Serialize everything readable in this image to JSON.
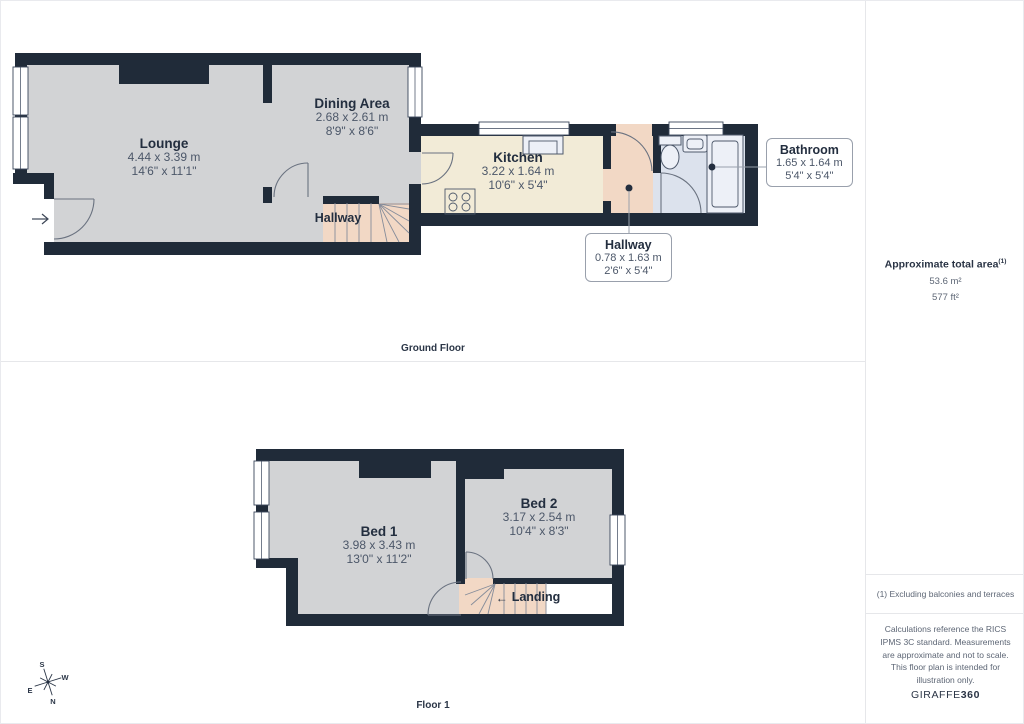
{
  "floors": {
    "ground": {
      "label": "Ground Floor"
    },
    "first": {
      "label": "Floor 1"
    }
  },
  "rooms": {
    "lounge": {
      "name": "Lounge",
      "metric": "4.44 x 3.39 m",
      "imperial": "14'6\" x 11'1\""
    },
    "dining": {
      "name": "Dining Area",
      "metric": "2.68 x 2.61 m",
      "imperial": "8'9\" x 8'6\""
    },
    "kitchen": {
      "name": "Kitchen",
      "metric": "3.22 x 1.64 m",
      "imperial": "10'6\" x 5'4\""
    },
    "hallway_ground": {
      "name": "Hallway"
    },
    "hallway_callout": {
      "name": "Hallway",
      "metric": "0.78 x 1.63 m",
      "imperial": "2'6\" x 5'4\""
    },
    "bathroom": {
      "name": "Bathroom",
      "metric": "1.65 x 1.64 m",
      "imperial": "5'4\" x 5'4\""
    },
    "bed1": {
      "name": "Bed 1",
      "metric": "3.98 x 3.43 m",
      "imperial": "13'0\" x 11'2\""
    },
    "bed2": {
      "name": "Bed 2",
      "metric": "3.17 x 2.54 m",
      "imperial": "10'4\" x 8'3\""
    },
    "landing": {
      "name": "Landing",
      "arrow": "←"
    }
  },
  "sidebar": {
    "area_title": "Approximate total area",
    "area_footnote_marker": "(1)",
    "area_metric": "53.6 m²",
    "area_imperial": "577 ft²",
    "footnote": "(1) Excluding balconies and terraces",
    "disclaimer": "Calculations reference the RICS IPMS 3C standard. Measurements are approximate and not to scale. This floor plan is intended for illustration only.",
    "brand_name": "GIRAFFE",
    "brand_suffix": "360"
  },
  "compass": {
    "n": "N",
    "s": "S",
    "e": "E",
    "w": "W"
  },
  "colors": {
    "wall": "#202b39",
    "room_fill": "#d2d3d5",
    "kitchen_fill": "#f2ebd7",
    "stair_fill": "#f2d8c5",
    "bathroom_fill": "#dce2ed",
    "accent_text": "#232e3f",
    "dim_text": "#4c5769",
    "muted_text": "#5d6675",
    "divider": "#e6e7ea",
    "line": "#6a7280"
  }
}
